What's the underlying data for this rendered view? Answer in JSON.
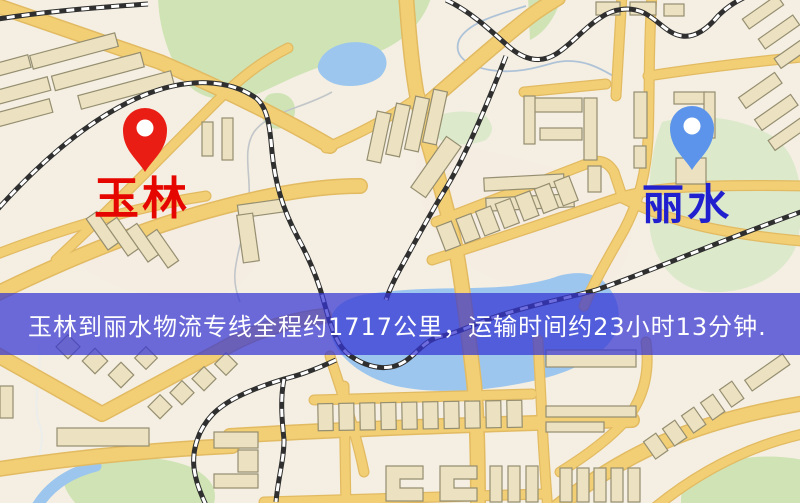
{
  "banner": {
    "text": "玉林到丽水物流专线全程约1717公里，运输时间约23小时13分钟."
  },
  "route": {
    "origin": "玉林",
    "destination": "丽水",
    "distance_text": "约1717公里",
    "duration_text": "约23小时13分钟"
  },
  "markers": {
    "origin": {
      "label": "玉林",
      "pin_color": "#ea1d15",
      "label_color": "#e60600"
    },
    "destination": {
      "label": "丽水",
      "pin_color": "#5b94ea",
      "label_color": "#2020cf"
    }
  },
  "map": {
    "colors": {
      "background": "#f4efe2",
      "road": "#f2cf74",
      "road_casing": "#e2ba62",
      "building": "#ece2c2",
      "building_outline": "#958e70",
      "park": "#cfe3b5",
      "water": "#9cc6ee",
      "railway": "#2f2f2f",
      "banner_background": "rgba(53,53,211,0.72)",
      "banner_text": "#ffffff"
    }
  }
}
